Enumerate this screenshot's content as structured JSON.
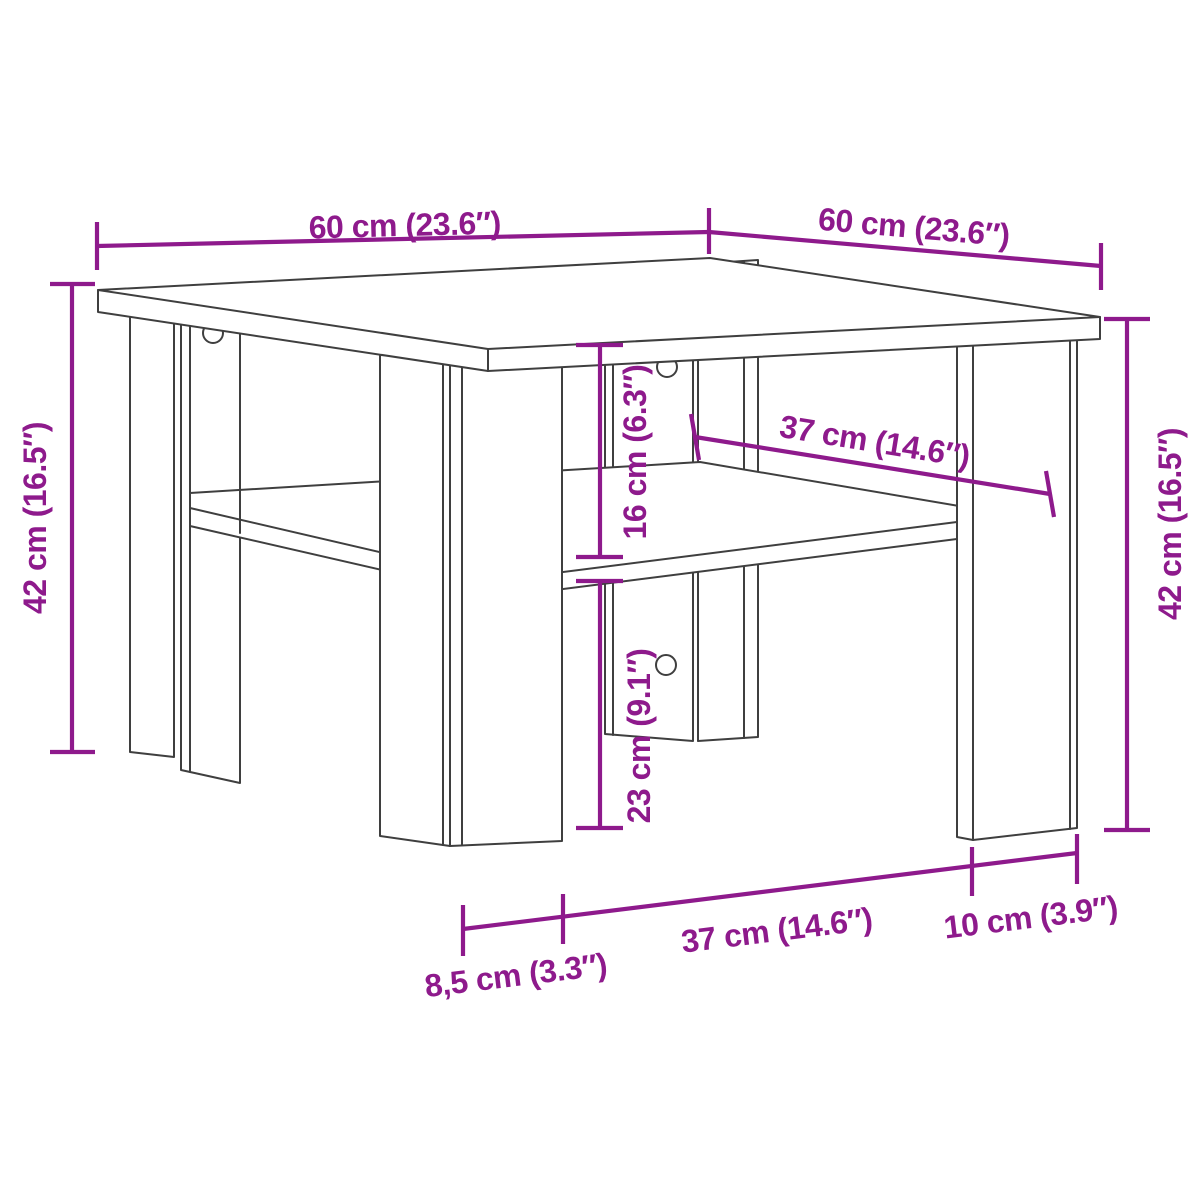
{
  "page": {
    "title": "Coffee table dimension diagram",
    "description": "Technical line drawing of a square two-tier coffee table (tabletop, four corner panel legs, lower shelf) annotated with magenta dimension lines",
    "background": "#ffffff"
  },
  "style": {
    "annotation_color": "#8e1a8c",
    "outline_color": "#3f3f3f"
  },
  "dimensions": {
    "top_width": {
      "label": "60 cm (23.6″)"
    },
    "top_depth": {
      "label": "60 cm (23.6″)"
    },
    "height_left": {
      "label": "42 cm (16.5″)"
    },
    "height_right": {
      "label": "42 cm (16.5″)"
    },
    "top_to_shelf": {
      "label": "16 cm (6.3″)"
    },
    "shelf_depth": {
      "label": "37 cm (14.6″)"
    },
    "below_shelf": {
      "label": "23 cm (9.1″)"
    },
    "front_leg_width": {
      "label": "8,5 cm (3.3″)"
    },
    "bottom_span": {
      "label": "37 cm (14.6″)"
    },
    "right_leg_width": {
      "label": "10 cm (3.9″)"
    }
  }
}
